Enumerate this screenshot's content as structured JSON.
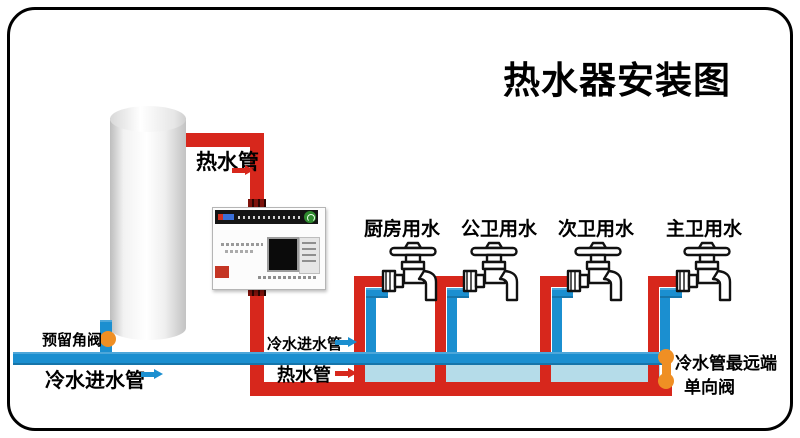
{
  "title": "热水器安装图",
  "colors": {
    "hot_pipe": "#d7271c",
    "cold_pipe": "#1b8fd0",
    "return_fill": "#b5dce9",
    "valve": "#ef8f24",
    "frame": "#000000"
  },
  "pipe_labels": {
    "hot_outlet": "热水管",
    "cold_inlet_main": "冷水进水管",
    "reserved_angle_valve": "预留角阀",
    "cold_inlet_mid": "冷水进水管",
    "hot_mid": "热水管",
    "cold_far_end": "冷水管最远端",
    "check_valve": "单向阀"
  },
  "faucets": [
    {
      "label": "厨房用水"
    },
    {
      "label": "公卫用水"
    },
    {
      "label": "次卫用水"
    },
    {
      "label": "主卫用水"
    }
  ]
}
